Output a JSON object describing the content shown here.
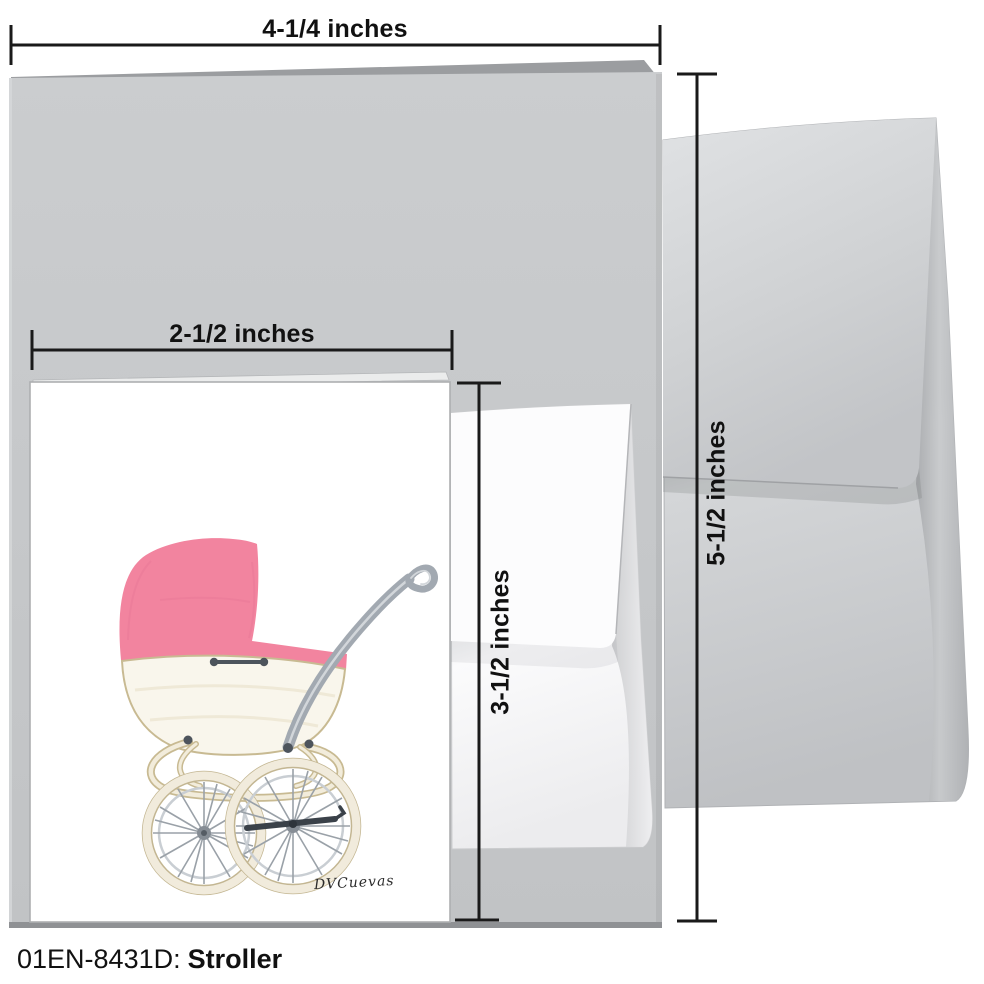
{
  "caption": {
    "code": "01EN-8431D:",
    "title": "Stroller"
  },
  "dimensions": {
    "card_width_label": "4-1/4 inches",
    "insert_width_label": "2-1/2 inches",
    "card_height_label": "5-1/2 inches",
    "insert_height_label": "3-1/2 inches"
  },
  "artwork": {
    "signature": "DVCuevas",
    "subject": "vintage pram illustration with pink canopy, cream body and wire-spoked wheels"
  },
  "palette": {
    "line": "#1a1a1a",
    "ink": "#111111",
    "card_gray": "#c7c9cb",
    "card_gray_dark": "#9b9da0",
    "card_edge_dark": "#8f9194",
    "envelope_gray_light": "#dcdee0",
    "envelope_gray": "#c6c8ca",
    "envelope_gray_dark": "#aaacaf",
    "canopy_pink": "#f2849f",
    "canopy_pink_deep": "#e97a97",
    "body_cream": "#f9f6ec",
    "cream_outline": "#c8ba92",
    "cream_tube": "#f2ecdb",
    "handle_gray": "#a2a9b1",
    "handle_light": "#d2d6da",
    "metal_dark": "#4d545c",
    "spoke_gray": "#9aa1a8",
    "rim_gray": "#c9ced3",
    "axle_dark": "#3a4149"
  }
}
